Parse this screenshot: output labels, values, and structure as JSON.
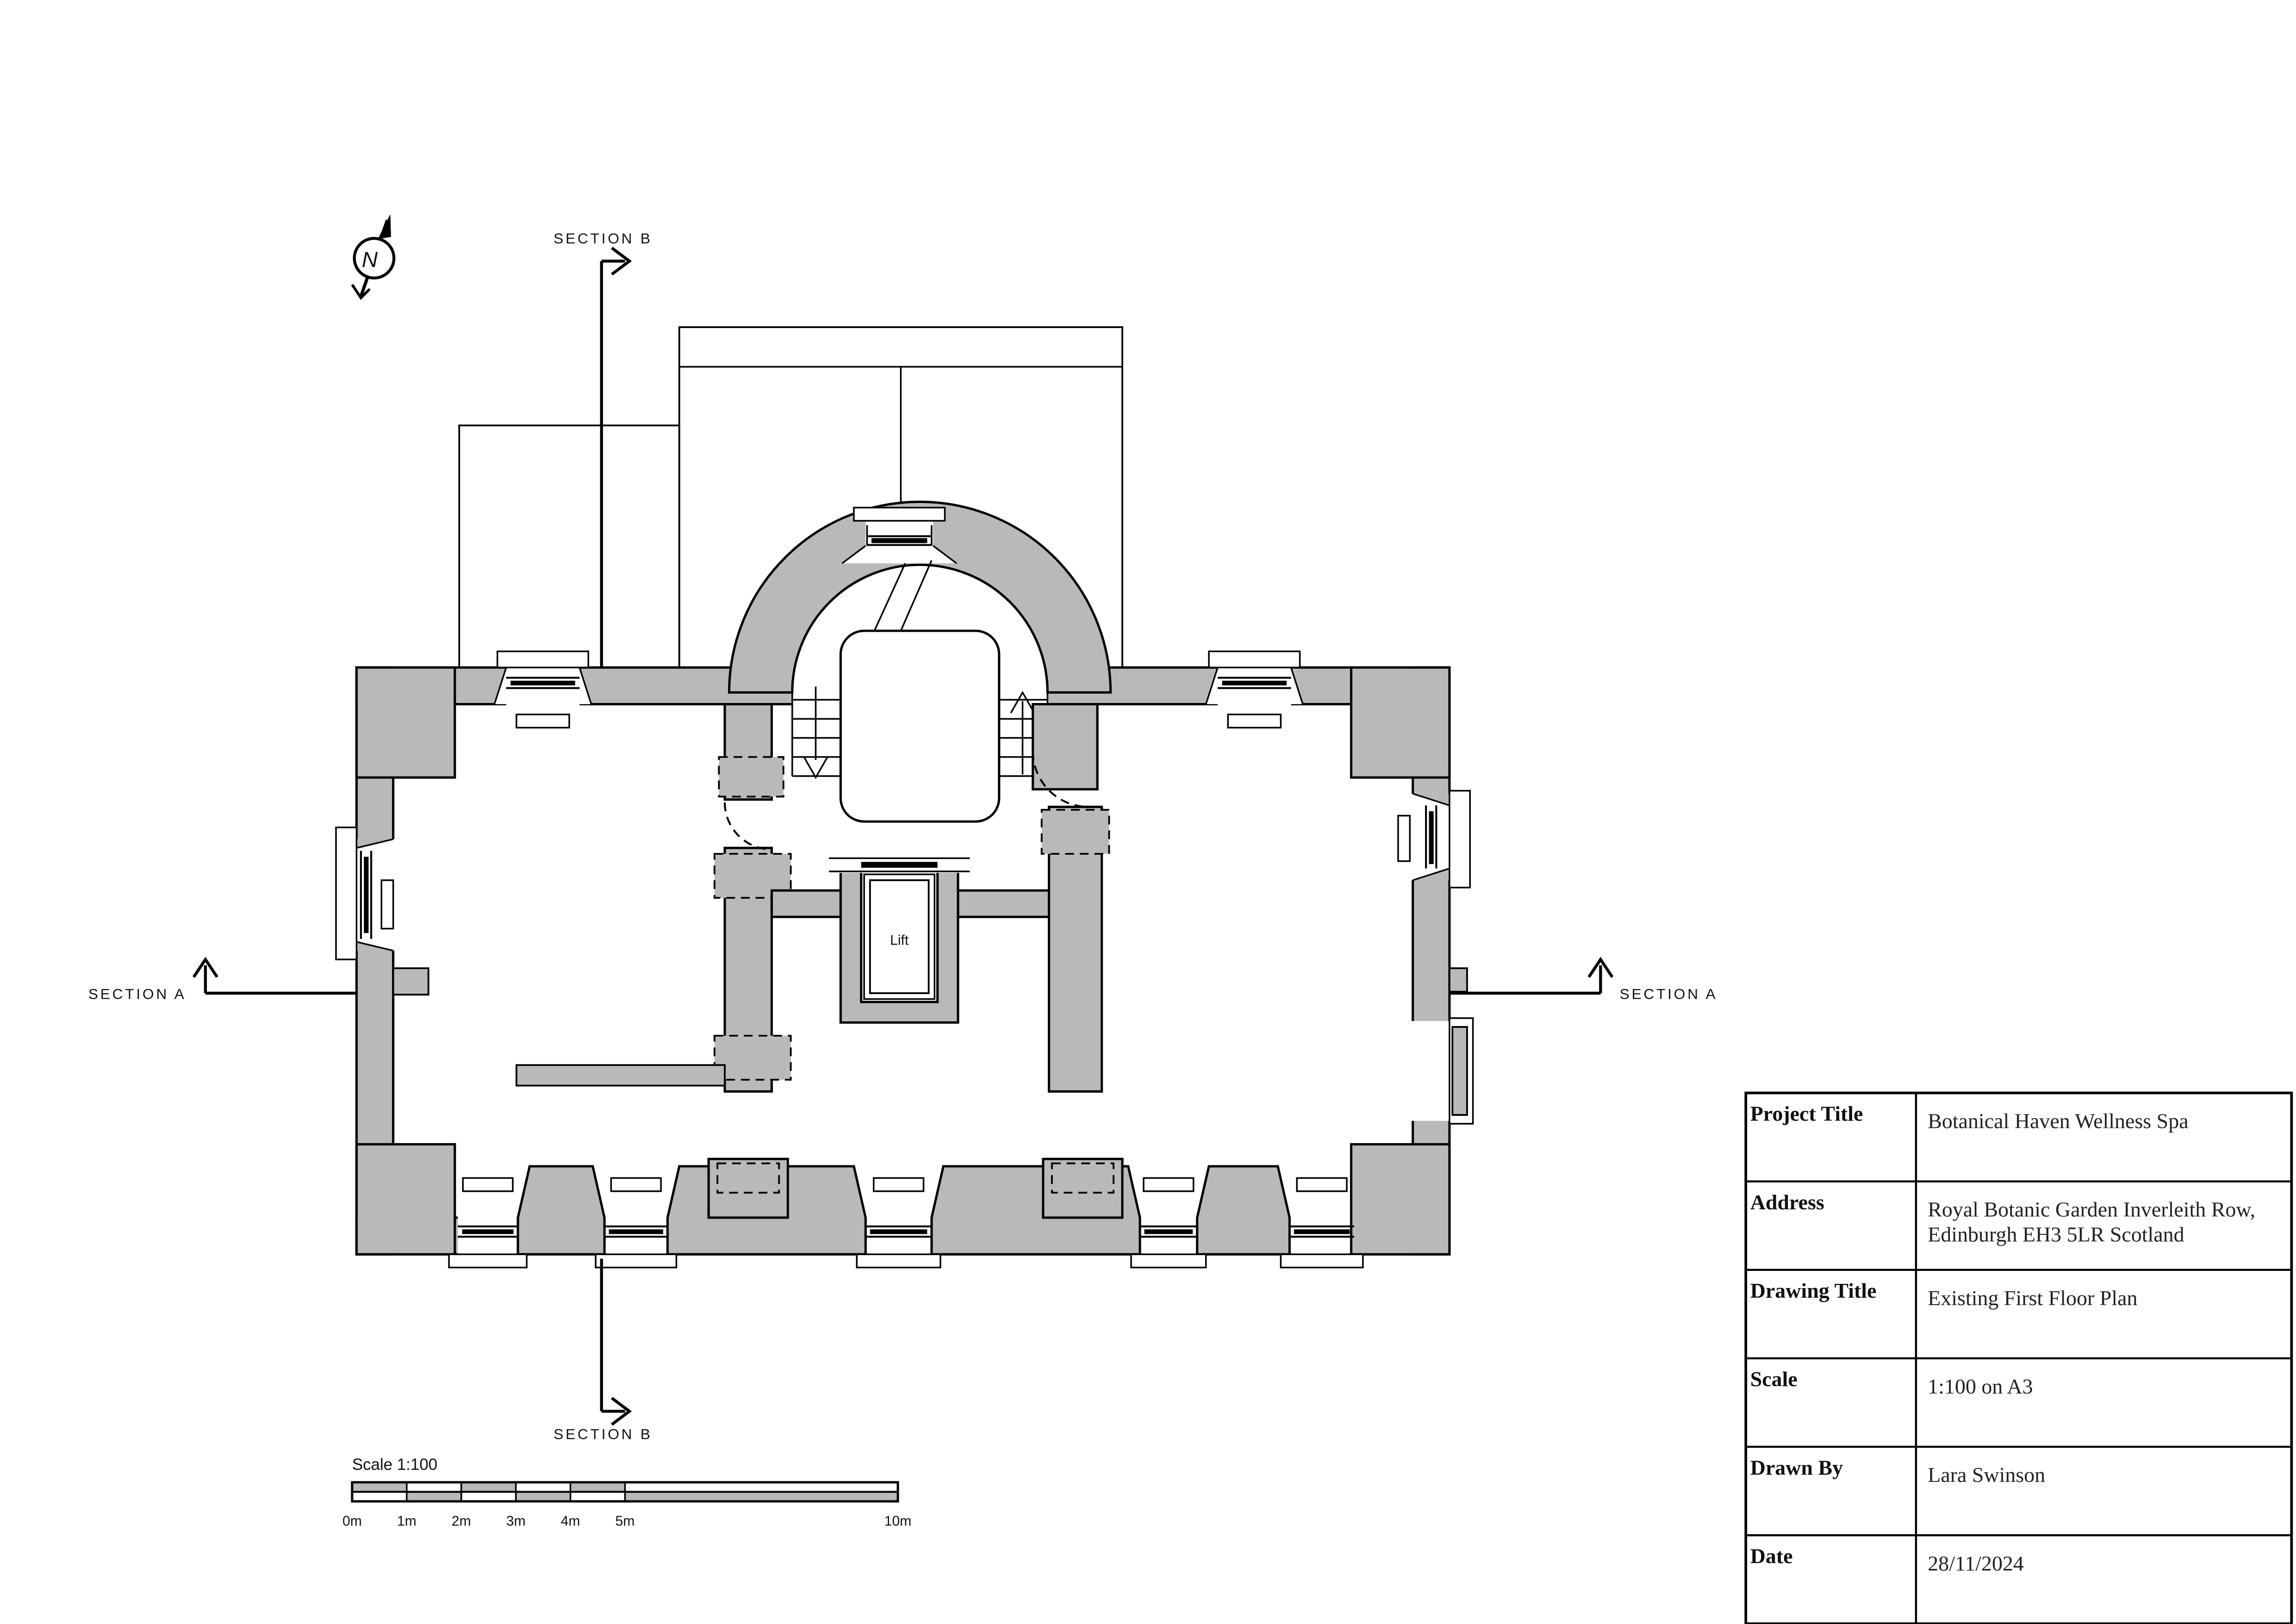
{
  "drawing": {
    "north_label": "N",
    "section_a_label": "SECTION A",
    "section_b_label": "SECTION B",
    "lift_label": "Lift"
  },
  "scalebar": {
    "title": "Scale 1:100",
    "ticks": [
      "0m",
      "1m",
      "2m",
      "3m",
      "4m",
      "5m",
      "10m"
    ]
  },
  "titleblock": {
    "rows": [
      {
        "label": "Project Title",
        "value": "Botanical Haven Wellness Spa"
      },
      {
        "label": "Address",
        "value": "Royal Botanic Garden Inverleith Row,",
        "value2": "Edinburgh EH3 5LR Scotland"
      },
      {
        "label": "Drawing Title",
        "value": "Existing First Floor Plan"
      },
      {
        "label": "Scale",
        "value": "1:100 on A3"
      },
      {
        "label": "Drawn By",
        "value": "Lara Swinson"
      },
      {
        "label": "Date",
        "value": "28/11/2024"
      }
    ]
  },
  "colors": {
    "wall_gray": "#b9b9b9",
    "line": "#000000",
    "background": "#ffffff"
  }
}
